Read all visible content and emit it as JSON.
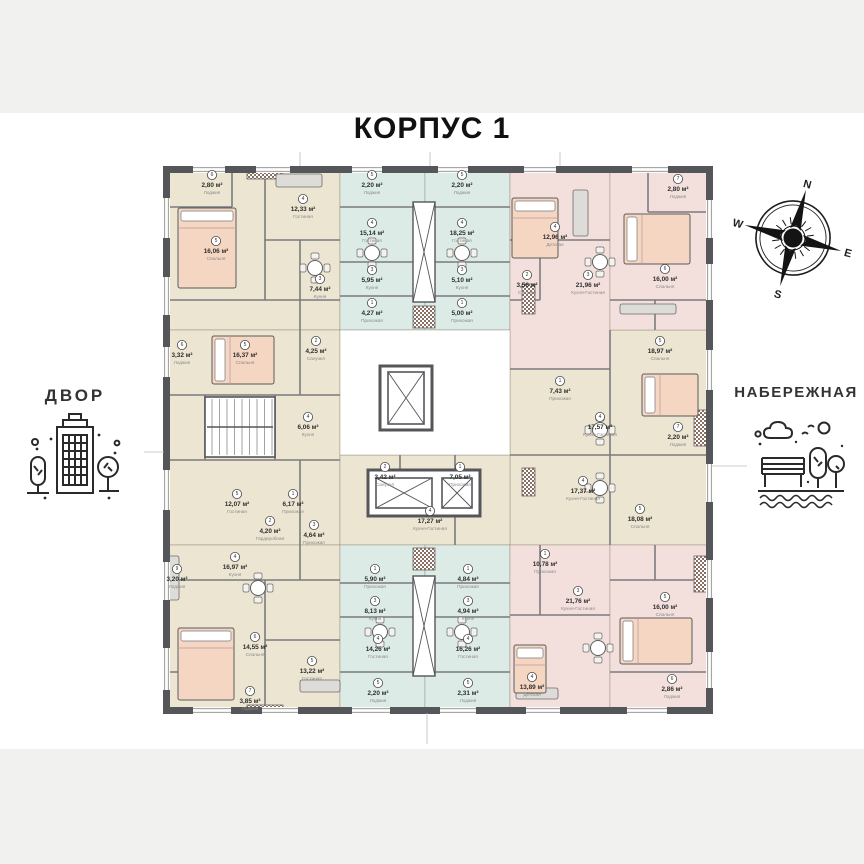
{
  "title": "КОРПУС 1",
  "left_label": "ДВОР",
  "right_label": "НАБЕРЕЖНАЯ",
  "compass": {
    "n": "N",
    "e": "E",
    "s": "S",
    "w": "W",
    "rotation_deg": 15
  },
  "colors": {
    "beige": "#ece5d2",
    "blue": "#dcebe6",
    "pink": "#f3e0dd",
    "white": "#ffffff",
    "wall": "#55565a",
    "divider": "#7a7b7e",
    "window_line": "#9b9b9b",
    "bed": "#f5d6c2",
    "checker": "#8a6e62",
    "furniture": "#dddcd8",
    "label_area": "#2f2f2f",
    "label_room": "#8a8a8a"
  },
  "plan": {
    "outer": [
      166.5,
      169.5,
      543,
      541
    ],
    "zones": [
      {
        "name": "apt-mid-right",
        "color": "beige",
        "r": [
          510,
          330,
          200,
          215
        ]
      },
      {
        "name": "apt-top-left",
        "color": "beige",
        "r": [
          166,
          169,
          174,
          161
        ]
      },
      {
        "name": "apt-mid-left",
        "color": "beige",
        "r": [
          166,
          330,
          174,
          215
        ]
      },
      {
        "name": "apt-bottom-left",
        "color": "beige",
        "r": [
          166,
          545,
          174,
          165
        ]
      },
      {
        "name": "studio-top-1",
        "color": "blue",
        "r": [
          340,
          169,
          85,
          161
        ]
      },
      {
        "name": "studio-top-2",
        "color": "blue",
        "r": [
          425,
          169,
          85,
          161
        ]
      },
      {
        "name": "apt-top-right-1",
        "color": "pink",
        "r": [
          510,
          169,
          100,
          200
        ]
      },
      {
        "name": "apt-top-right-2",
        "color": "pink",
        "r": [
          610,
          169,
          100,
          161
        ]
      },
      {
        "name": "apt-mid-center",
        "color": "beige",
        "r": [
          340,
          455,
          170,
          90
        ]
      },
      {
        "name": "studio-bottom-1",
        "color": "blue",
        "r": [
          340,
          545,
          85,
          165
        ]
      },
      {
        "name": "studio-bottom-2",
        "color": "blue",
        "r": [
          425,
          545,
          85,
          165
        ]
      },
      {
        "name": "apt-bottom-right-1",
        "color": "pink",
        "r": [
          510,
          545,
          100,
          165
        ]
      },
      {
        "name": "apt-bottom-right-2",
        "color": "pink",
        "r": [
          610,
          545,
          100,
          165
        ]
      },
      {
        "name": "core",
        "color": "white",
        "r": [
          340,
          330,
          170,
          125
        ]
      }
    ],
    "dividers": [
      [
        265,
        169,
        265,
        300
      ],
      [
        166,
        300,
        340,
        300
      ],
      [
        300,
        240,
        300,
        330
      ],
      [
        265,
        240,
        340,
        240
      ],
      [
        166,
        207,
        232,
        207
      ],
      [
        232,
        169,
        232,
        207
      ],
      [
        166,
        395,
        340,
        395
      ],
      [
        166,
        460,
        340,
        460
      ],
      [
        205,
        395,
        205,
        460
      ],
      [
        275,
        395,
        275,
        460
      ],
      [
        300,
        330,
        300,
        395
      ],
      [
        300,
        460,
        300,
        545
      ],
      [
        340,
        207,
        425,
        207
      ],
      [
        340,
        262,
        425,
        262
      ],
      [
        340,
        296,
        425,
        296
      ],
      [
        425,
        207,
        510,
        207
      ],
      [
        425,
        262,
        510,
        262
      ],
      [
        425,
        296,
        510,
        296
      ],
      [
        510,
        240,
        610,
        240
      ],
      [
        540,
        240,
        540,
        300
      ],
      [
        510,
        300,
        540,
        300
      ],
      [
        648,
        169,
        648,
        212
      ],
      [
        648,
        212,
        710,
        212
      ],
      [
        610,
        300,
        710,
        300
      ],
      [
        655,
        300,
        655,
        330
      ],
      [
        510,
        455,
        710,
        455
      ],
      [
        610,
        330,
        610,
        545
      ],
      [
        510,
        369,
        610,
        369
      ],
      [
        400,
        455,
        400,
        515
      ],
      [
        455,
        455,
        455,
        545
      ],
      [
        265,
        580,
        265,
        710
      ],
      [
        166,
        580,
        340,
        580
      ],
      [
        300,
        545,
        300,
        580
      ],
      [
        166,
        672,
        232,
        672
      ],
      [
        265,
        640,
        340,
        640
      ],
      [
        340,
        672,
        425,
        672
      ],
      [
        340,
        617,
        425,
        617
      ],
      [
        340,
        583,
        425,
        583
      ],
      [
        425,
        672,
        510,
        672
      ],
      [
        425,
        617,
        510,
        617
      ],
      [
        425,
        583,
        510,
        583
      ],
      [
        510,
        615,
        610,
        615
      ],
      [
        540,
        545,
        540,
        615
      ],
      [
        610,
        580,
        710,
        580
      ],
      [
        655,
        545,
        655,
        580
      ],
      [
        610,
        672,
        710,
        672
      ]
    ],
    "windows": {
      "top": [
        [
          193,
          32
        ],
        [
          256,
          34
        ],
        [
          352,
          30
        ],
        [
          438,
          30
        ],
        [
          524,
          32
        ],
        [
          632,
          36
        ]
      ],
      "bottom": [
        [
          193,
          38
        ],
        [
          262,
          36
        ],
        [
          352,
          38
        ],
        [
          440,
          36
        ],
        [
          526,
          34
        ],
        [
          627,
          40
        ]
      ],
      "left": [
        [
          198,
          40
        ],
        [
          277,
          38
        ],
        [
          347,
          30
        ],
        [
          470,
          40
        ],
        [
          562,
          38
        ],
        [
          648,
          42
        ]
      ],
      "right": [
        [
          200,
          38
        ],
        [
          264,
          36
        ],
        [
          350,
          40
        ],
        [
          464,
          38
        ],
        [
          560,
          38
        ],
        [
          652,
          36
        ]
      ]
    },
    "checkers": [
      [
        522,
        284,
        13,
        30
      ],
      [
        522,
        468,
        13,
        28
      ],
      [
        694,
        410,
        14,
        36
      ],
      [
        694,
        556,
        14,
        36
      ],
      [
        247,
        171,
        36,
        8
      ],
      [
        247,
        705,
        36,
        7
      ]
    ],
    "shafts": [
      {
        "chk": [
          413,
          306,
          22,
          22
        ],
        "box": [
          413,
          202,
          22,
          100
        ]
      },
      {
        "chk": [
          413,
          548,
          22,
          22
        ],
        "box": [
          413,
          576,
          22,
          100
        ]
      }
    ],
    "core": {
      "walls": [
        [
          380,
          366,
          52,
          64
        ],
        [
          368,
          470,
          112,
          46
        ]
      ],
      "elevators": [
        [
          388,
          372,
          36,
          52
        ],
        [
          376,
          478,
          56,
          30
        ],
        [
          442,
          478,
          30,
          30
        ]
      ],
      "stairs": [
        205,
        397,
        70,
        60
      ]
    },
    "beds": [
      [
        178,
        208,
        58,
        80
      ],
      [
        212,
        336,
        62,
        48
      ],
      [
        512,
        198,
        46,
        60
      ],
      [
        624,
        214,
        66,
        50
      ],
      [
        642,
        374,
        56,
        42
      ],
      [
        620,
        618,
        72,
        46
      ],
      [
        178,
        628,
        56,
        72
      ],
      [
        514,
        645,
        32,
        48
      ]
    ],
    "tables": [
      [
        315,
        268
      ],
      [
        372,
        253
      ],
      [
        462,
        253
      ],
      [
        600,
        262
      ],
      [
        600,
        430
      ],
      [
        600,
        488
      ],
      [
        598,
        648
      ],
      [
        258,
        588
      ],
      [
        380,
        632
      ],
      [
        462,
        632
      ]
    ],
    "sofas": [
      [
        276,
        174,
        46,
        13
      ],
      [
        573,
        190,
        15,
        46
      ],
      [
        620,
        304,
        56,
        10
      ],
      [
        300,
        680,
        40,
        12
      ],
      [
        168,
        556,
        11,
        44
      ],
      [
        516,
        688,
        42,
        11
      ]
    ],
    "ticks": [
      [
        144,
        452,
        164,
        452
      ],
      [
        711,
        466,
        747,
        466
      ],
      [
        427,
        713,
        427,
        744
      ],
      [
        300,
        152,
        300,
        166
      ],
      [
        430,
        152,
        430,
        166
      ],
      [
        560,
        152,
        560,
        166
      ]
    ],
    "labels": [
      {
        "x": 212,
        "y": 186,
        "n": "6",
        "a": "2,80 м²",
        "r": "Лоджия"
      },
      {
        "x": 216,
        "y": 252,
        "n": "5",
        "a": "16,06 м²",
        "r": "Спальня"
      },
      {
        "x": 303,
        "y": 210,
        "n": "4",
        "a": "12,33 м²",
        "r": "Гостиная"
      },
      {
        "x": 320,
        "y": 290,
        "n": "3",
        "a": "7,44 м²",
        "r": "Кухня"
      },
      {
        "x": 182,
        "y": 356,
        "n": "6",
        "a": "3,32 м²",
        "r": "Лоджия"
      },
      {
        "x": 245,
        "y": 356,
        "n": "5",
        "a": "16,37 м²",
        "r": "Спальня"
      },
      {
        "x": 316,
        "y": 352,
        "n": "2",
        "a": "4,25 м²",
        "r": "Санузел"
      },
      {
        "x": 308,
        "y": 428,
        "n": "4",
        "a": "6,06 м²",
        "r": "Кухня"
      },
      {
        "x": 237,
        "y": 505,
        "n": "5",
        "a": "12,07 м²",
        "r": "Гостиная"
      },
      {
        "x": 293,
        "y": 505,
        "n": "1",
        "a": "6,17 м²",
        "r": "Прихожая"
      },
      {
        "x": 270,
        "y": 532,
        "n": "2",
        "a": "4,20 м²",
        "r": "Гардеробная"
      },
      {
        "x": 314,
        "y": 536,
        "n": "3",
        "a": "4,64 м²",
        "r": "Прихожая"
      },
      {
        "x": 372,
        "y": 186,
        "n": "5",
        "a": "2,20 м²",
        "r": "Лоджия"
      },
      {
        "x": 372,
        "y": 234,
        "n": "4",
        "a": "15,14 м²",
        "r": "Гостиная"
      },
      {
        "x": 372,
        "y": 281,
        "n": "3",
        "a": "5,95 м²",
        "r": "Кухня"
      },
      {
        "x": 372,
        "y": 314,
        "n": "1",
        "a": "4,27 м²",
        "r": "Прихожая"
      },
      {
        "x": 462,
        "y": 186,
        "n": "5",
        "a": "2,20 м²",
        "r": "Лоджия"
      },
      {
        "x": 462,
        "y": 234,
        "n": "4",
        "a": "18,25 м²",
        "r": "Гостиная"
      },
      {
        "x": 462,
        "y": 281,
        "n": "3",
        "a": "5,10 м²",
        "r": "Кухня"
      },
      {
        "x": 462,
        "y": 314,
        "n": "1",
        "a": "5,00 м²",
        "r": "Прихожая"
      },
      {
        "x": 555,
        "y": 238,
        "n": "4",
        "a": "12,96 м²",
        "r": "Детская"
      },
      {
        "x": 588,
        "y": 286,
        "n": "3",
        "a": "21,96 м²",
        "r": "Кухня-Гостиная"
      },
      {
        "x": 527,
        "y": 286,
        "n": "2",
        "a": "3,56 м²",
        "r": "Санузел"
      },
      {
        "x": 678,
        "y": 190,
        "n": "7",
        "a": "2,80 м²",
        "r": "Лоджия"
      },
      {
        "x": 665,
        "y": 280,
        "n": "6",
        "a": "16,00 м²",
        "r": "Спальня"
      },
      {
        "x": 560,
        "y": 392,
        "n": "1",
        "a": "7,43 м²",
        "r": "Прихожая"
      },
      {
        "x": 660,
        "y": 352,
        "n": "5",
        "a": "18,97 м²",
        "r": "Спальня"
      },
      {
        "x": 600,
        "y": 428,
        "n": "4",
        "a": "17,57 м²",
        "r": "Кухня-Гостиная"
      },
      {
        "x": 583,
        "y": 492,
        "n": "4",
        "a": "17,37 м²",
        "r": "Кухня-Гостиная"
      },
      {
        "x": 678,
        "y": 438,
        "n": "7",
        "a": "2,20 м²",
        "r": "Лоджия"
      },
      {
        "x": 640,
        "y": 520,
        "n": "5",
        "a": "18,08 м²",
        "r": "Спальня"
      },
      {
        "x": 460,
        "y": 478,
        "n": "1",
        "a": "7,05 м²",
        "r": "Прихожая"
      },
      {
        "x": 385,
        "y": 478,
        "n": "2",
        "a": "3,42 м²",
        "r": "Санузел"
      },
      {
        "x": 430,
        "y": 522,
        "n": "4",
        "a": "17,27 м²",
        "r": "Кухня-Гостиная"
      },
      {
        "x": 375,
        "y": 580,
        "n": "1",
        "a": "5,90 м²",
        "r": "Прихожая"
      },
      {
        "x": 375,
        "y": 612,
        "n": "3",
        "a": "8,13 м²",
        "r": "Кухня"
      },
      {
        "x": 378,
        "y": 650,
        "n": "4",
        "a": "14,26 м²",
        "r": "Гостиная"
      },
      {
        "x": 378,
        "y": 694,
        "n": "5",
        "a": "2,20 м²",
        "r": "Лоджия"
      },
      {
        "x": 468,
        "y": 580,
        "n": "1",
        "a": "4,84 м²",
        "r": "Прихожая"
      },
      {
        "x": 468,
        "y": 612,
        "n": "3",
        "a": "4,94 м²",
        "r": "Кухня"
      },
      {
        "x": 468,
        "y": 650,
        "n": "4",
        "a": "16,26 м²",
        "r": "Гостиная"
      },
      {
        "x": 468,
        "y": 694,
        "n": "5",
        "a": "2,31 м²",
        "r": "Лоджия"
      },
      {
        "x": 545,
        "y": 565,
        "n": "1",
        "a": "10,78 м²",
        "r": "Прихожая"
      },
      {
        "x": 578,
        "y": 602,
        "n": "3",
        "a": "21,76 м²",
        "r": "Кухня-Гостиная"
      },
      {
        "x": 665,
        "y": 608,
        "n": "5",
        "a": "16,00 м²",
        "r": "Спальня"
      },
      {
        "x": 532,
        "y": 688,
        "n": "4",
        "a": "13,89 м²",
        "r": "Детская"
      },
      {
        "x": 672,
        "y": 690,
        "n": "6",
        "a": "2,86 м²",
        "r": "Лоджия"
      },
      {
        "x": 235,
        "y": 568,
        "n": "4",
        "a": "16,97 м²",
        "r": "Кухня"
      },
      {
        "x": 177,
        "y": 580,
        "n": "9",
        "a": "3,20 м²",
        "r": "Лоджия"
      },
      {
        "x": 255,
        "y": 648,
        "n": "6",
        "a": "14,55 м²",
        "r": "Спальня"
      },
      {
        "x": 312,
        "y": 672,
        "n": "5",
        "a": "13,22 м²",
        "r": "Гостиная"
      },
      {
        "x": 250,
        "y": 702,
        "n": "7",
        "a": "3,85 м²",
        "r": "Лоджия"
      }
    ]
  }
}
